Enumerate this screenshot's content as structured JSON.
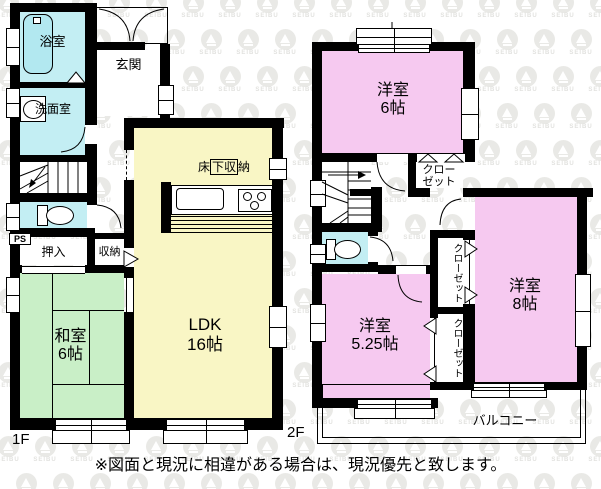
{
  "note": "※図面と現況に相違がある場合は、現況優先と致します。",
  "watermark": {
    "brand": "SEIBU"
  },
  "floor1": {
    "label": "1F",
    "genkan": "玄関",
    "bath": "浴室",
    "washroom": "洗面室",
    "ps": "PS",
    "oshiire": "押入",
    "storage": "収納",
    "underfloor_pre": "床",
    "underfloor_boxed": "下収",
    "underfloor_post": "納",
    "ldk_name": "LDK",
    "ldk_size": "16帖",
    "washitsu_name": "和室",
    "washitsu_size": "6帖"
  },
  "floor2": {
    "label": "2F",
    "room6_name": "洋室",
    "room6_size": "6帖",
    "room8_name": "洋室",
    "room8_size": "8帖",
    "room525_name": "洋室",
    "room525_size": "5.25帖",
    "closet_line1": "クロー",
    "closet_line2": "ゼット",
    "closet_vertical": "クローゼット",
    "balcony": "バルコニー"
  },
  "colors": {
    "wall": "#000000",
    "water": "#c3eef3",
    "tub": "#b2e8f0",
    "ldk": "#f9f6c5",
    "tatami": "#c9efc7",
    "western": "#f6c9f0",
    "watermark": "#e9e9e6",
    "watermark_text": "#e2e2df",
    "text": "#000000"
  }
}
